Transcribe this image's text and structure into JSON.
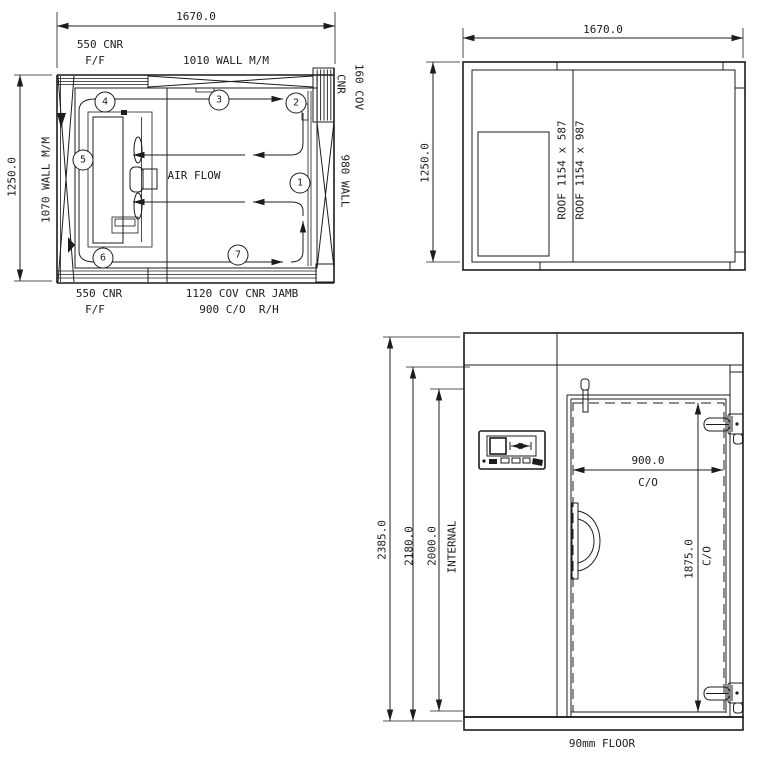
{
  "plan": {
    "dim_width": "1670.0",
    "dim_height": "1250.0",
    "corner_top": "550 CNR",
    "corner_top_sub": "F/F",
    "wall_top": "1010 WALL M/M",
    "cov_cnr_line1": "160 COV",
    "cov_cnr_line2": "CNR",
    "wall_right": "980 WALL",
    "wall_left": "1070 WALL M/M",
    "air_flow": "AIR FLOW",
    "corner_bottom": "550 CNR",
    "corner_bottom_sub": "F/F",
    "jamb_label": "1120 COV CNR JAMB",
    "opening_label": "900 C/O  R/H",
    "markers": [
      "1",
      "2",
      "3",
      "4",
      "5",
      "6",
      "7"
    ]
  },
  "roof": {
    "dim_width": "1670.0",
    "dim_height": "1250.0",
    "panel1": "ROOF 1154 x 587",
    "panel2": "ROOF 1154 x 987"
  },
  "elevation": {
    "dim_overall": "2385.0",
    "dim_external": "2180.0",
    "dim_internal": "2000.0",
    "internal_label": "INTERNAL",
    "door_width": "900.0",
    "door_width_unit": "C/O",
    "door_height": "1875.0",
    "door_height_unit": "C/O",
    "floor_label": "90mm FLOOR"
  },
  "colors": {
    "line": "#1c1c1c",
    "background": "#ffffff"
  }
}
